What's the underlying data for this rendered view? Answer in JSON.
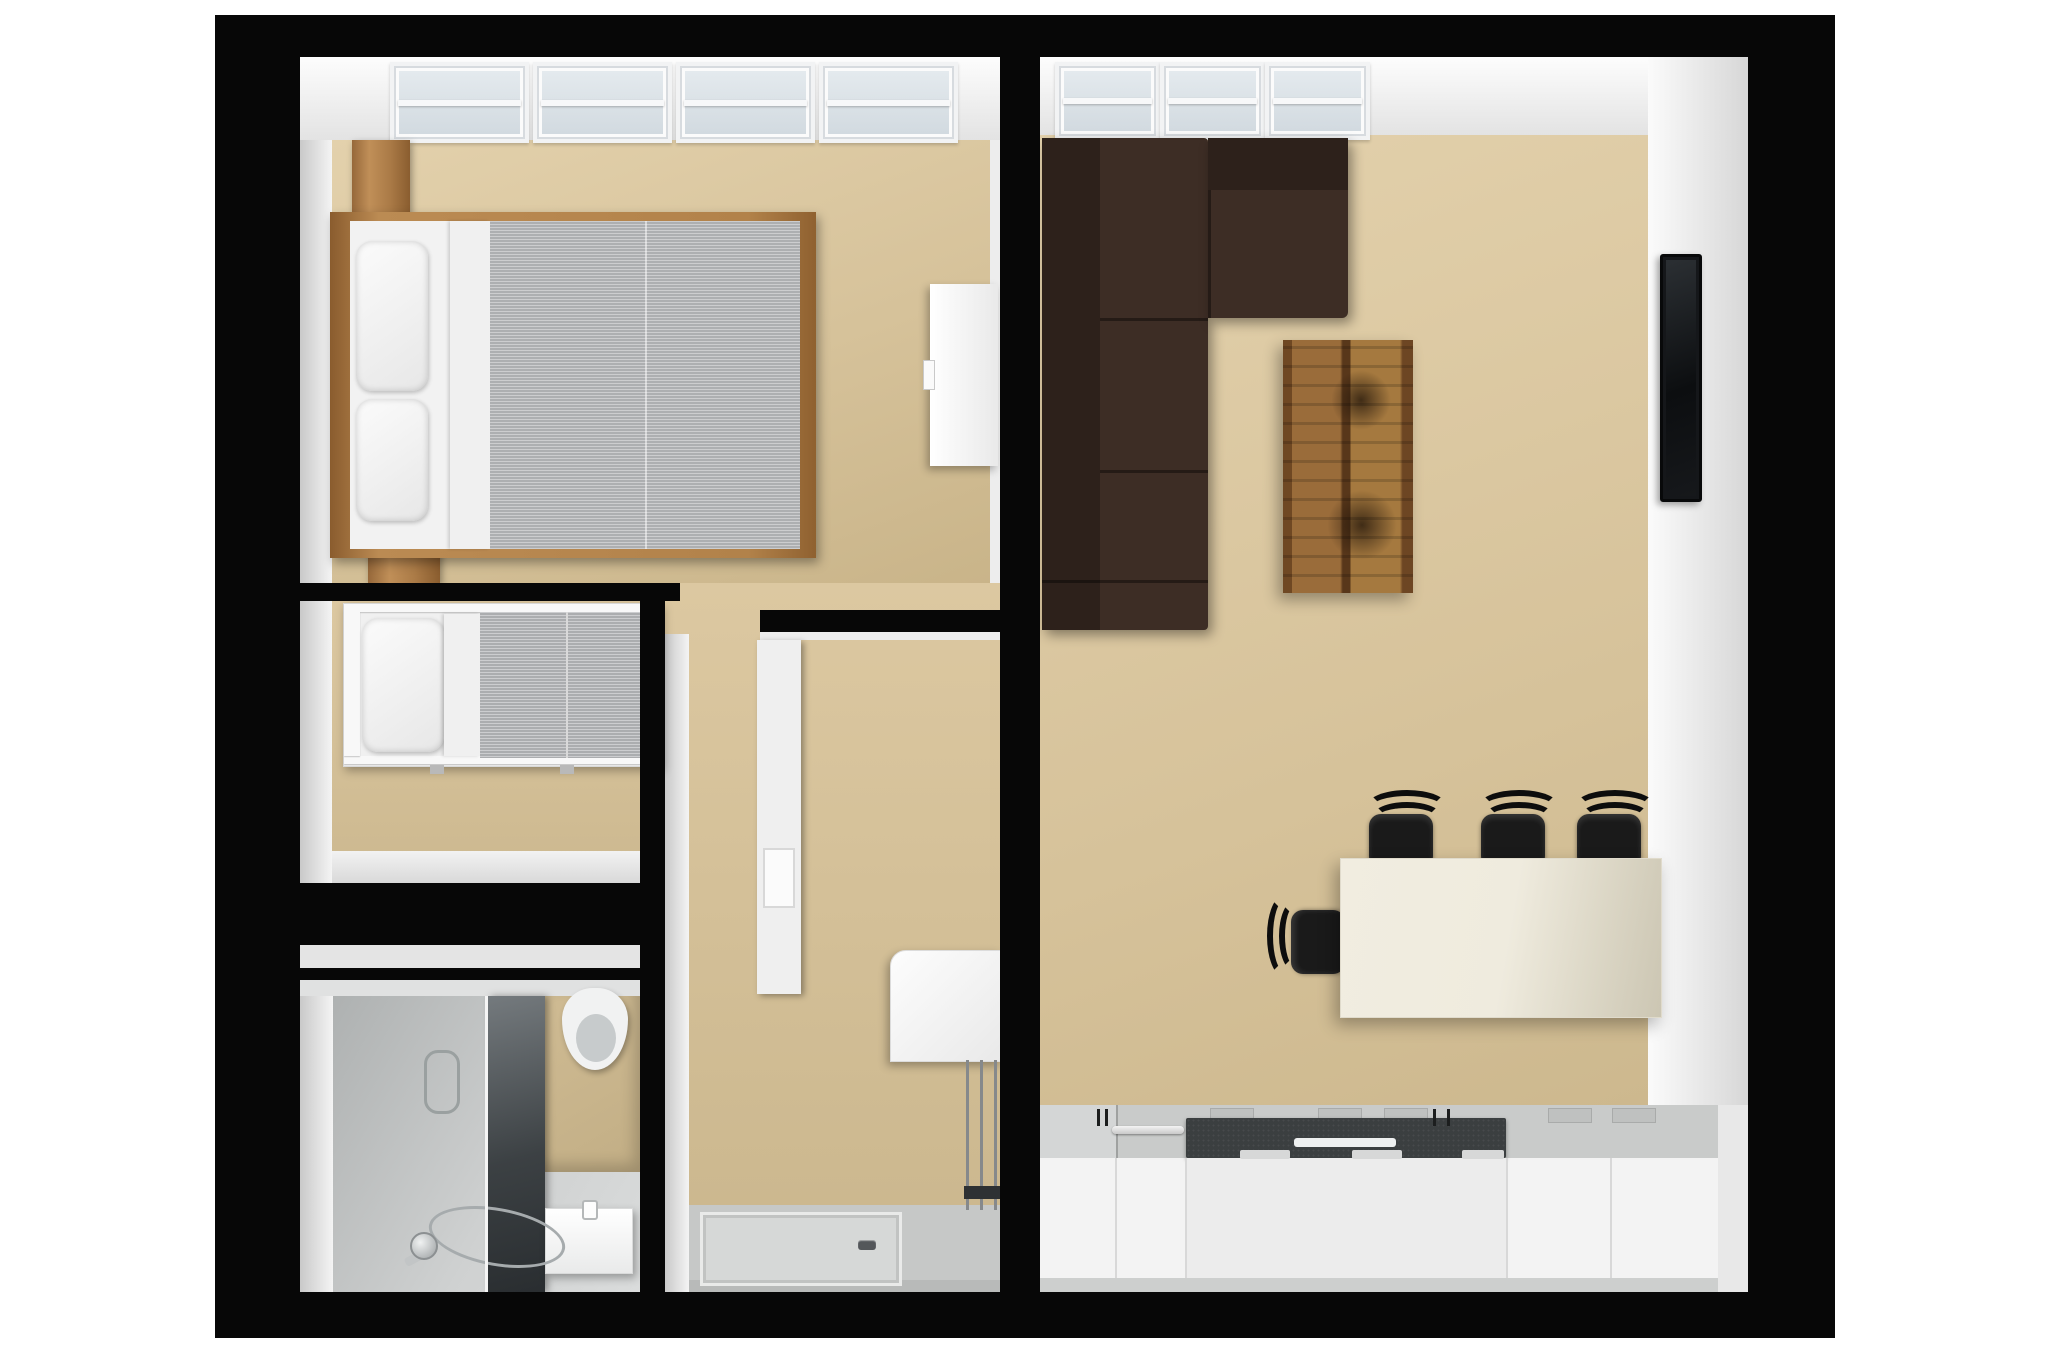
{
  "scene": {
    "type": "3d-floorplan-top-down-render",
    "background": "#ffffff",
    "no_visible_text": true
  },
  "colors": {
    "wall": "#070707",
    "floor_beige": "#d6c29a",
    "floor_grey": "#c7c9c9",
    "wall_face": "#f2f2f2",
    "window_glass": "#e4eaee",
    "sofa_brown": "#352720",
    "bed_wood": "#b08350",
    "coffee_table_wood": "#8a5c2f",
    "linen_white": "#f3f3f3",
    "mattress_grey": "#b7b9bb",
    "dining_table_cream": "#efebde",
    "chair_black": "#161616",
    "counter_grey": "#c9cbca",
    "counter_charcoal": "#3b3f40",
    "cabinet_white": "#f3f3f3",
    "tv_black": "#0e1012"
  },
  "rooms": [
    {
      "id": "master-bedroom",
      "position": "top-left",
      "skylight_windows": 4,
      "furniture": [
        "double-bed",
        "two-pillows",
        "grey-duvet",
        "wooden-nightstand-top",
        "wooden-nightstand-bottom",
        "white-dresser"
      ]
    },
    {
      "id": "kids-bedroom",
      "position": "middle-left",
      "skylight_windows": 0,
      "furniture": [
        "single-bed",
        "pillow",
        "grey-mattress"
      ]
    },
    {
      "id": "bathroom",
      "position": "bottom-left",
      "furniture": [
        "shower-glass-panel",
        "hand-shower-on-floor",
        "square-wash-basin",
        "wall-hung-toilet"
      ]
    },
    {
      "id": "hallway-utility",
      "position": "middle",
      "furniture": [
        "tall-white-panel-door",
        "washing-machine",
        "towel-radiator-pipes",
        "shower-tray-with-drain"
      ]
    },
    {
      "id": "living-room-kitchen",
      "position": "right",
      "skylight_windows": 3,
      "furniture": [
        "brown-corner-sofa",
        "rustic-coffee-table",
        "wall-mounted-tv",
        "cream-dining-table",
        "four-black-chairs",
        "kitchen-counter-with-charcoal-worktop-and-sink"
      ]
    }
  ]
}
